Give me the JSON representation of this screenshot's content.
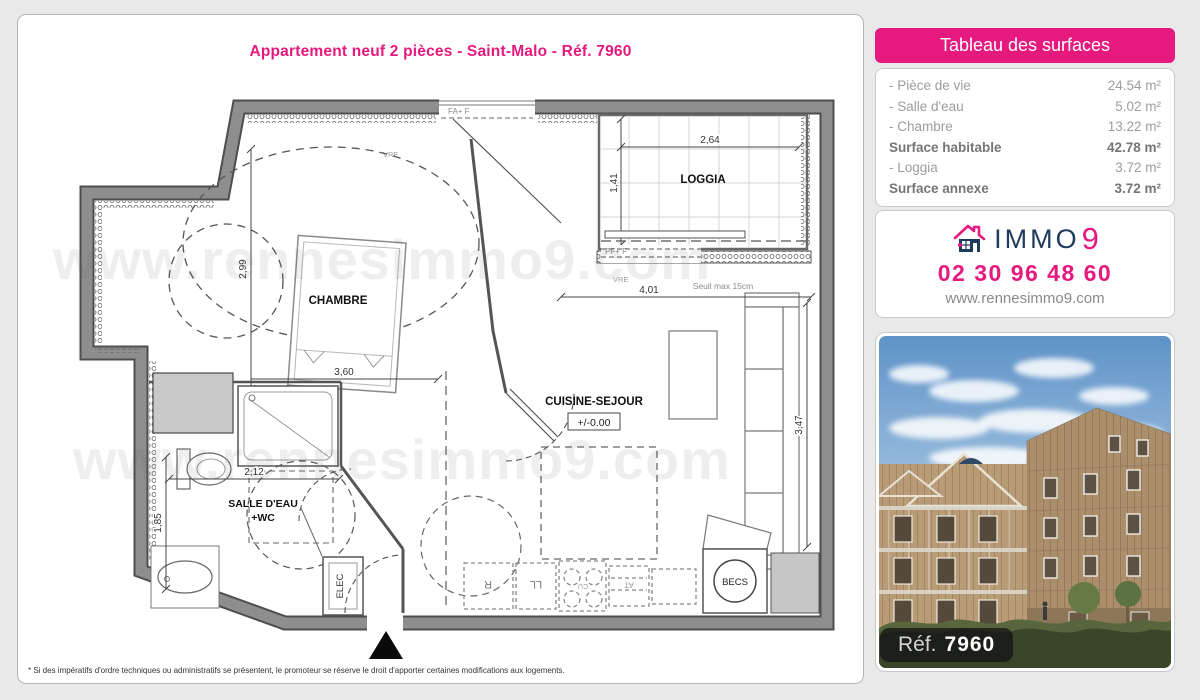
{
  "page": {
    "title": "Appartement neuf 2 pièces - Saint-Malo - Réf. 7960",
    "watermark": "www.rennesimmo9.com",
    "disclaimer": "* Si des impératifs d'ordre techniques ou administratifs se présentent, le promoteur se réserve le droit d'apporter certaines modifications aux logements."
  },
  "surfaces": {
    "header": "Tableau des surfaces",
    "rows": [
      {
        "label": "- Pièce de vie",
        "value": "24.54 m²"
      },
      {
        "label": "- Salle d'eau",
        "value": "5.02 m²"
      },
      {
        "label": "- Chambre",
        "value": "13.22 m²"
      },
      {
        "label": "Surface habitable",
        "value": "42.78 m²"
      },
      {
        "label": "- Loggia",
        "value": "3.72 m²"
      },
      {
        "label": "Surface annexe",
        "value": "3.72 m²"
      }
    ]
  },
  "agency": {
    "brand": "IMMO",
    "brand_number": "9",
    "phone": "02 30 96 48 60",
    "website": "www.rennesimmo9.com"
  },
  "photo": {
    "ref_label": "Réf.",
    "ref_value": "7960"
  },
  "plan": {
    "rooms": {
      "chambre": "CHAMBRE",
      "loggia": "LOGGIA",
      "cuisine": "CUISINE-SEJOUR",
      "salle_eau_1": "SALLE D'EAU",
      "salle_eau_2": "+WC"
    },
    "level": "+/-0.00",
    "dims": {
      "chambre_h": "2,99",
      "chambre_w": "3,60",
      "sde_w": "2,12",
      "sde_h": "1,85",
      "loggia_w": "2,64",
      "loggia_h": "1,41",
      "sejour_w": "4,01",
      "sejour_h": "3,47"
    },
    "annotations": {
      "fa_f": "FA+ F",
      "pf_f": "PF+ F",
      "vre": "VRE",
      "seuil": "Seuil max 15cm",
      "elec": "ELEC",
      "becs": "BECS",
      "fridge": "R",
      "washer": "LL",
      "hob": "CU",
      "at": "AT"
    }
  },
  "colors": {
    "pink": "#e6197f",
    "navy": "#1e3a5c"
  }
}
